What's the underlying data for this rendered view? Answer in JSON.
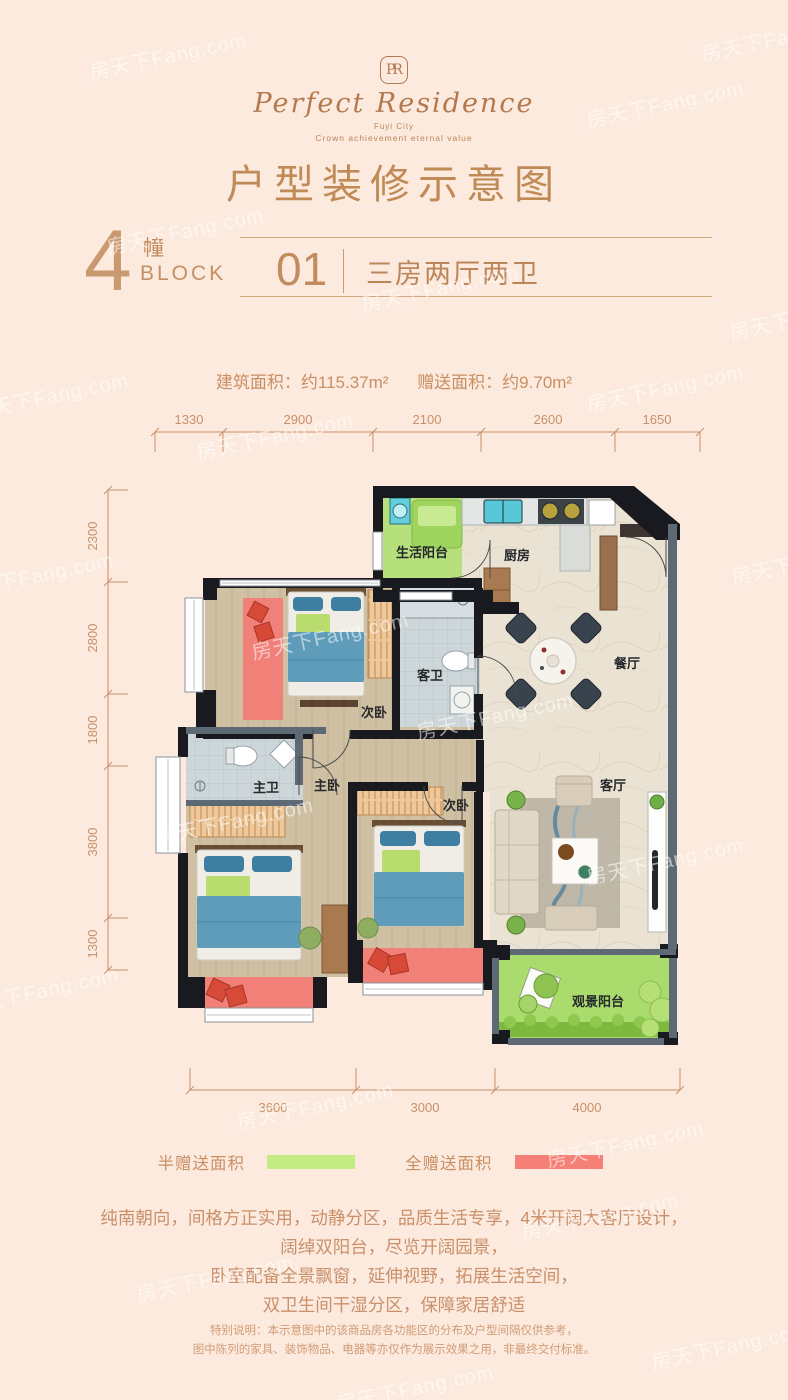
{
  "watermark": {
    "text": "房天下Fang.com"
  },
  "logo": {
    "monogram": "PR",
    "name": "Perfect Residence",
    "sub1": "Fuyi City",
    "sub2": "Crown achievement eternal value"
  },
  "title": "户型装修示意图",
  "block": {
    "number": "4",
    "unit_cn": "幢",
    "unit_en": "BLOCK",
    "suite_no": "01",
    "layout_name": "三房两厅两卫"
  },
  "areas": {
    "built": "建筑面积：约115.37m²",
    "gift": "赠送面积：约9.70m²"
  },
  "floorplan": {
    "dims_top": [
      "1330",
      "2900",
      "2100",
      "2600",
      "1650"
    ],
    "dims_left": [
      "2300",
      "2800",
      "1800",
      "3800",
      "1300"
    ],
    "dims_bottom": [
      "3600",
      "3000",
      "4000"
    ],
    "rooms": {
      "life_balcony": "生活阳台",
      "kitchen": "厨房",
      "dining": "餐厅",
      "bedroom2": "次卧",
      "guest_bath": "客卫",
      "master_bath": "主卫",
      "master_bedroom": "主卧",
      "bedroom3": "次卧",
      "living": "客厅",
      "view_balcony": "观景阳台"
    }
  },
  "legend": {
    "half_gift": {
      "label": "半赠送面积",
      "color": "#c3ec83"
    },
    "full_gift": {
      "label": "全赠送面积",
      "color": "#f58077"
    }
  },
  "description": {
    "line1": "纯南朝向，间格方正实用，动静分区，品质生活专享，4米开阔大客厅设计，",
    "line2": "阔绰双阳台，尽览开阔园景，",
    "line3": "卧室配备全景飘窗，延伸视野，拓展生活空间，",
    "line4": "双卫生间干湿分区，保障家居舒适"
  },
  "note": {
    "line1": "特别说明：本示意图中的该商品房各功能区的分布及户型间隔仅供参考，",
    "line2": "图中陈列的家具、装饰物品、电器等亦仅作为展示效果之用，非最终交付标准。"
  }
}
